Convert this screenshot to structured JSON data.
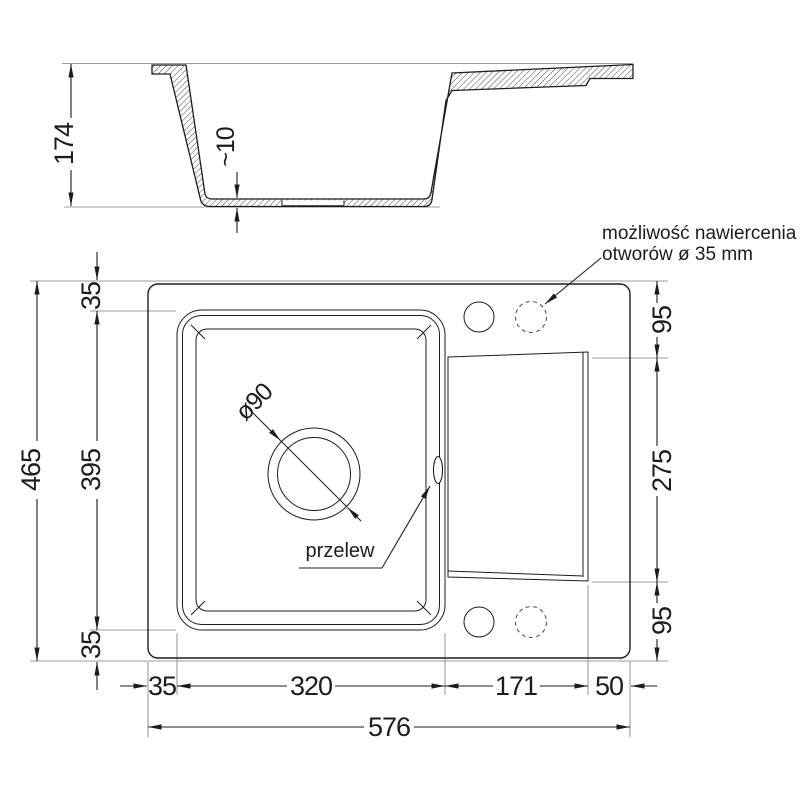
{
  "page": {
    "background": "#ffffff"
  },
  "colors": {
    "object_line": "#1c1c1c",
    "extension_line": "#9b9b9b",
    "hatch_line": "#1c1c1c",
    "text": "#1c1c1c"
  },
  "section_view": {
    "dim_total_height": "174",
    "dim_bottom_thickness": "~10"
  },
  "plan_view": {
    "dims_left": {
      "total": "465",
      "top": "35",
      "middle": "395",
      "bottom": "35"
    },
    "dims_right": {
      "top": "95",
      "middle": "275",
      "bottom": "95"
    },
    "dims_bottom": {
      "seg1": "35",
      "seg2": "320",
      "seg3": "171",
      "seg4": "50",
      "total": "576"
    },
    "labels": {
      "drain_diameter": "ø90",
      "overflow": "przelew",
      "note_line1": "możliwość nawiercenia",
      "note_line2": "otworów ø 35 mm"
    }
  }
}
